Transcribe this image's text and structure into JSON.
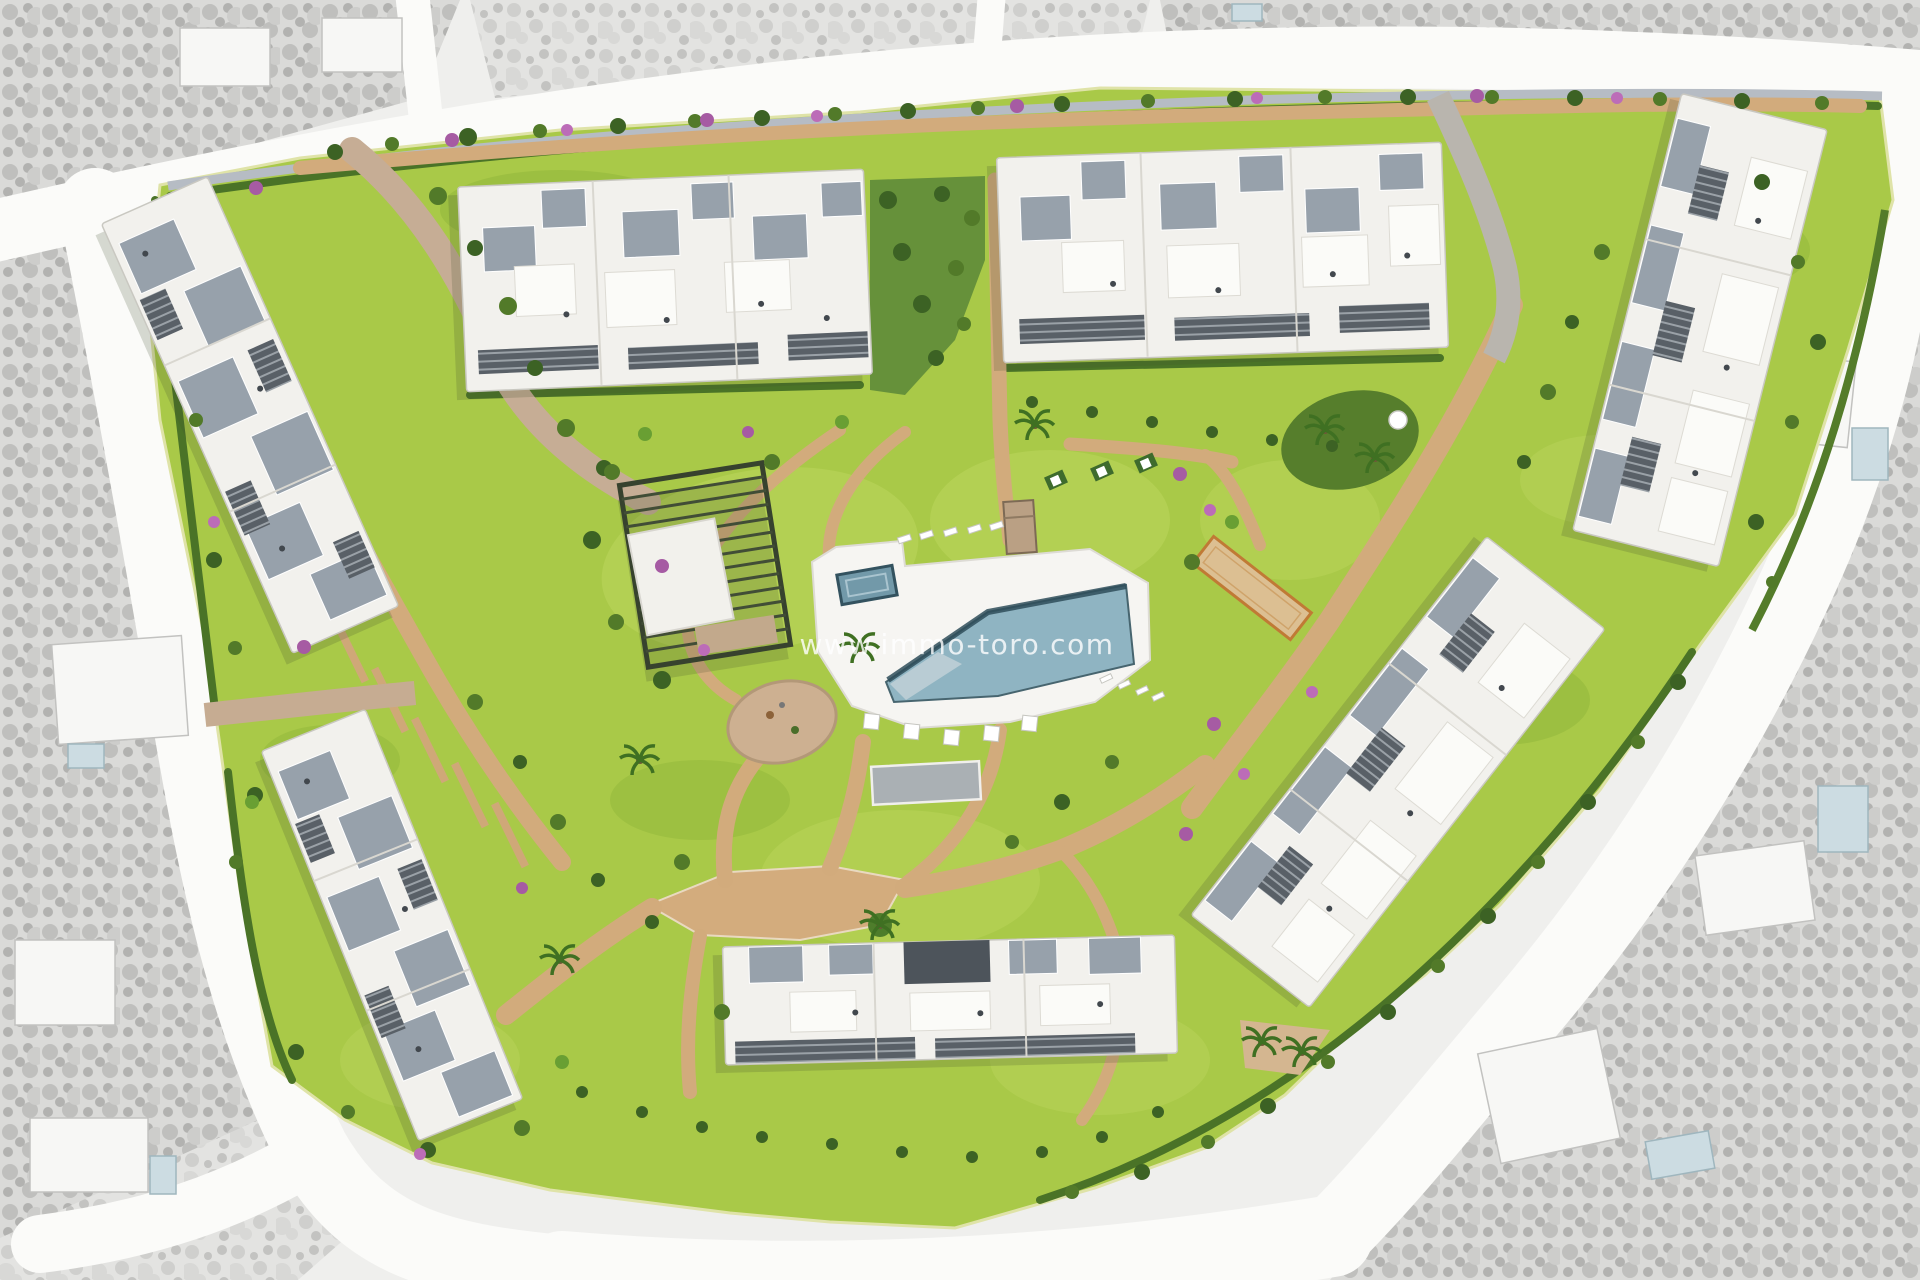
{
  "watermark": {
    "text": "www.immo-toro.com"
  },
  "scene": {
    "type": "aerial-site-plan-render",
    "subject": "new-build residential apartment complex with communal gardens and swimming pool",
    "surroundings_style": "desaturated grayscale neighborhood with white roads, villas and private pools",
    "site_shape": "rounded triangular plot",
    "apartment_buildings": 7,
    "amenities": [
      "swimming-pool",
      "kids-pool",
      "pool-deck",
      "sun-loungers",
      "parasols",
      "bar-pavilion",
      "gym-building",
      "pergola",
      "playground",
      "petanque-court",
      "palm-garden",
      "walking-paths",
      "central-plaza",
      "tree-lined-boulevard",
      "landscaped-gardens"
    ],
    "palette": {
      "lawn": "#a9c948",
      "lawn_light": "#bdd75e",
      "lawn_dark": "#8fb539",
      "hedge": "#4a7327",
      "tree_dark": "#3c6224",
      "path_tan": "#d2ab7c",
      "pool_water": "#8fb4c2",
      "pool_edge": "#33525f",
      "building_white": "#f2f1ed",
      "building_gray": "#97a1ab",
      "slat_dark": "#596067",
      "court_orange": "#c07a35",
      "flowers_purple": "#a65ba3",
      "road_white": "#fbfbf9",
      "surroundings_gray": "#e3e3e1",
      "watermark_white": "rgba(255,255,255,0.8)"
    }
  }
}
